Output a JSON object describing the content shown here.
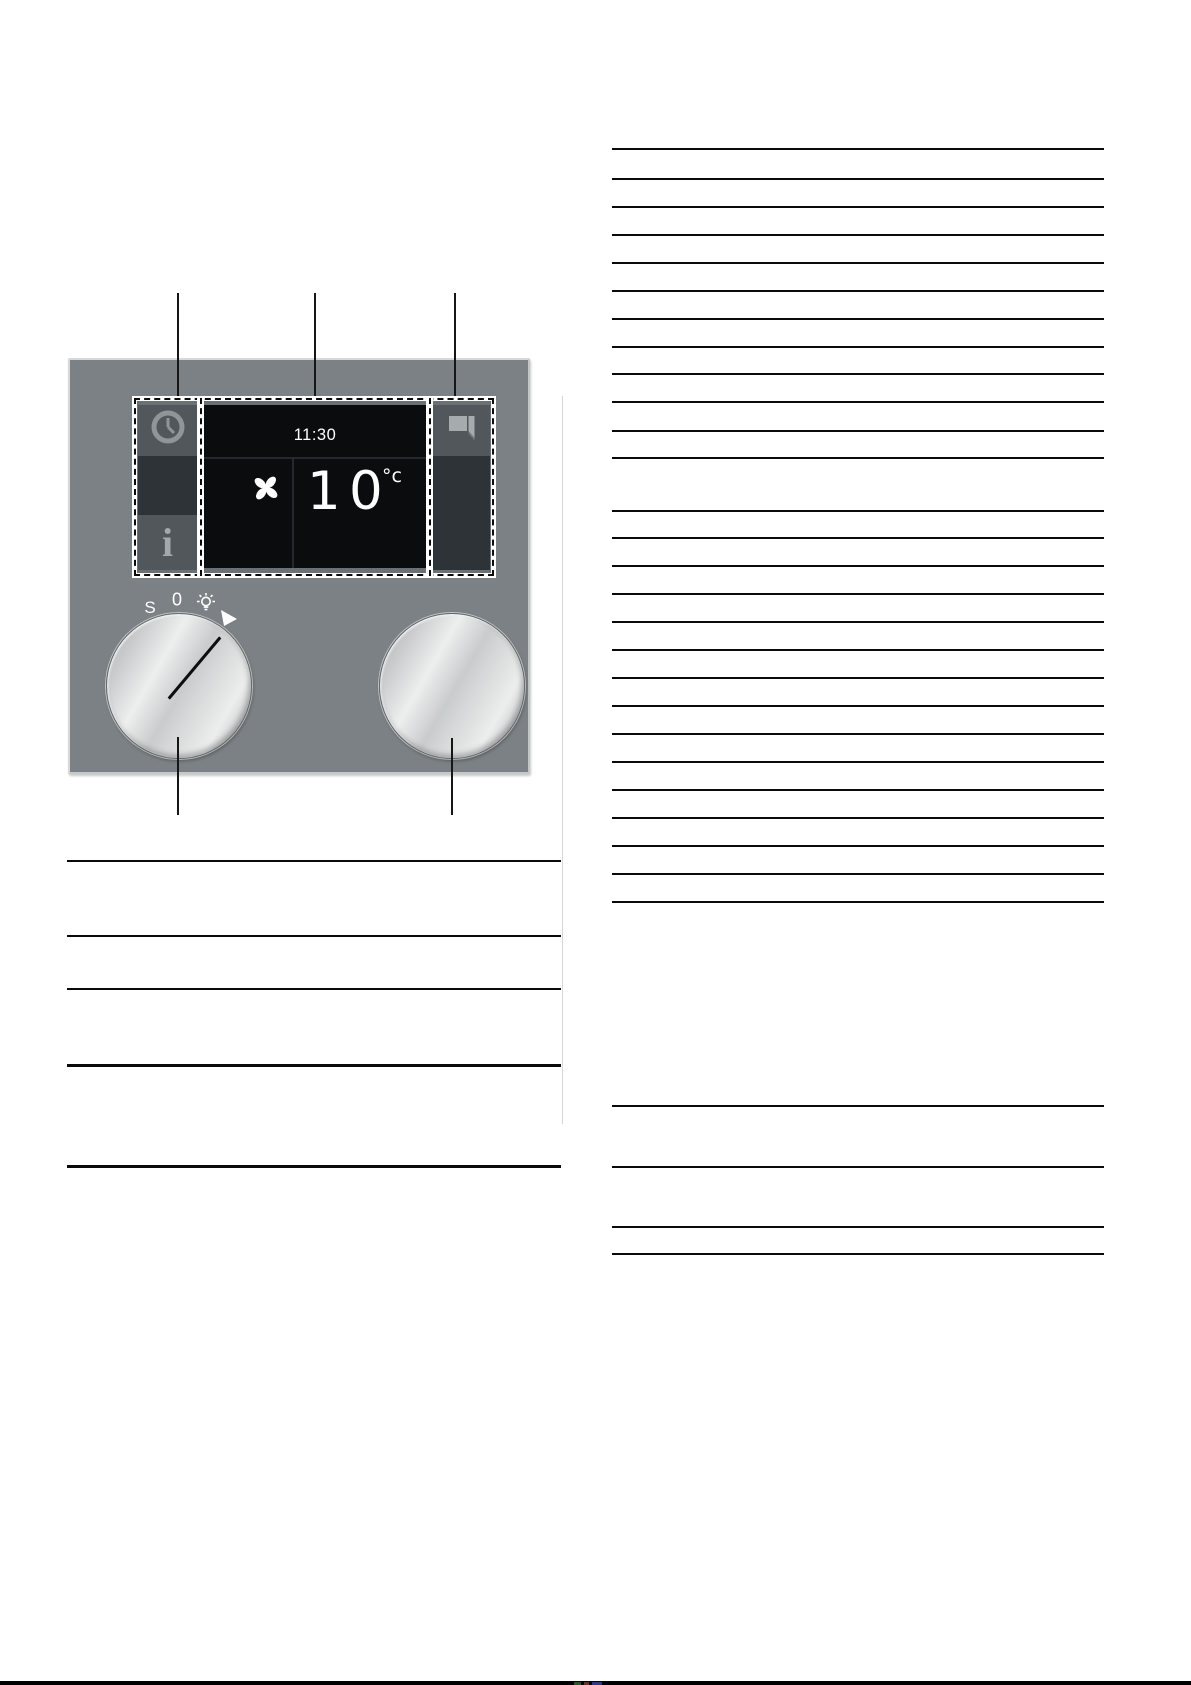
{
  "figure": {
    "type": "appliance-control-panel-diagram",
    "panel_color": "#7b8184",
    "display": {
      "time": "11:30",
      "temp_digit_1": "1",
      "temp_digit_2": "0",
      "temp_unit": "°c",
      "background": "#0a0c0d",
      "icons": [
        "clock-icon",
        "info-icon",
        "fan-icon",
        "door-icon"
      ]
    },
    "left_knob": {
      "mark_s": "S",
      "mark_zero": "0",
      "icons": [
        "light-icon",
        "pointer-triangle-icon"
      ],
      "has_indicator_line": true
    },
    "right_knob": {
      "has_indicator_line": false
    }
  },
  "callouts": {
    "top_lines_x": [
      177,
      314,
      454
    ],
    "top_y": 293,
    "top_height": 104,
    "bottom_lines": [
      {
        "x": 177,
        "y": 737,
        "h": 78
      },
      {
        "x": 451,
        "y": 738,
        "h": 77
      }
    ]
  },
  "left_column_rules": {
    "x": 67,
    "width": 494,
    "color": "#0a0a0a",
    "lines": [
      {
        "y": 860,
        "t": 1.5
      },
      {
        "y": 935,
        "t": 1.5
      },
      {
        "y": 988,
        "t": 1.5
      },
      {
        "y": 1064,
        "t": 3
      },
      {
        "y": 1165,
        "t": 3
      }
    ]
  },
  "right_column_rules": {
    "x": 612,
    "width": 492,
    "color": "#0a0a0a",
    "thickness": 1.5,
    "line_ys": [
      148,
      178,
      206,
      234,
      262,
      290,
      318,
      346,
      373,
      401,
      430,
      457,
      510,
      537,
      565,
      593,
      621,
      649,
      677,
      705,
      733,
      761,
      789,
      817,
      845,
      873,
      901,
      1105,
      1166,
      1226,
      1253
    ]
  },
  "scan_artifacts": {
    "gutter_crease_color": "#b3b7b8",
    "bottom_bar": {
      "y": 1681,
      "h": 4,
      "color": "#000000"
    },
    "bottom_marks": [
      {
        "x": 574,
        "w": 7,
        "color": "#2e6b2e"
      },
      {
        "x": 584,
        "w": 5,
        "color": "#8a3a3a"
      },
      {
        "x": 592,
        "w": 10,
        "color": "#3a4a9a"
      }
    ]
  }
}
